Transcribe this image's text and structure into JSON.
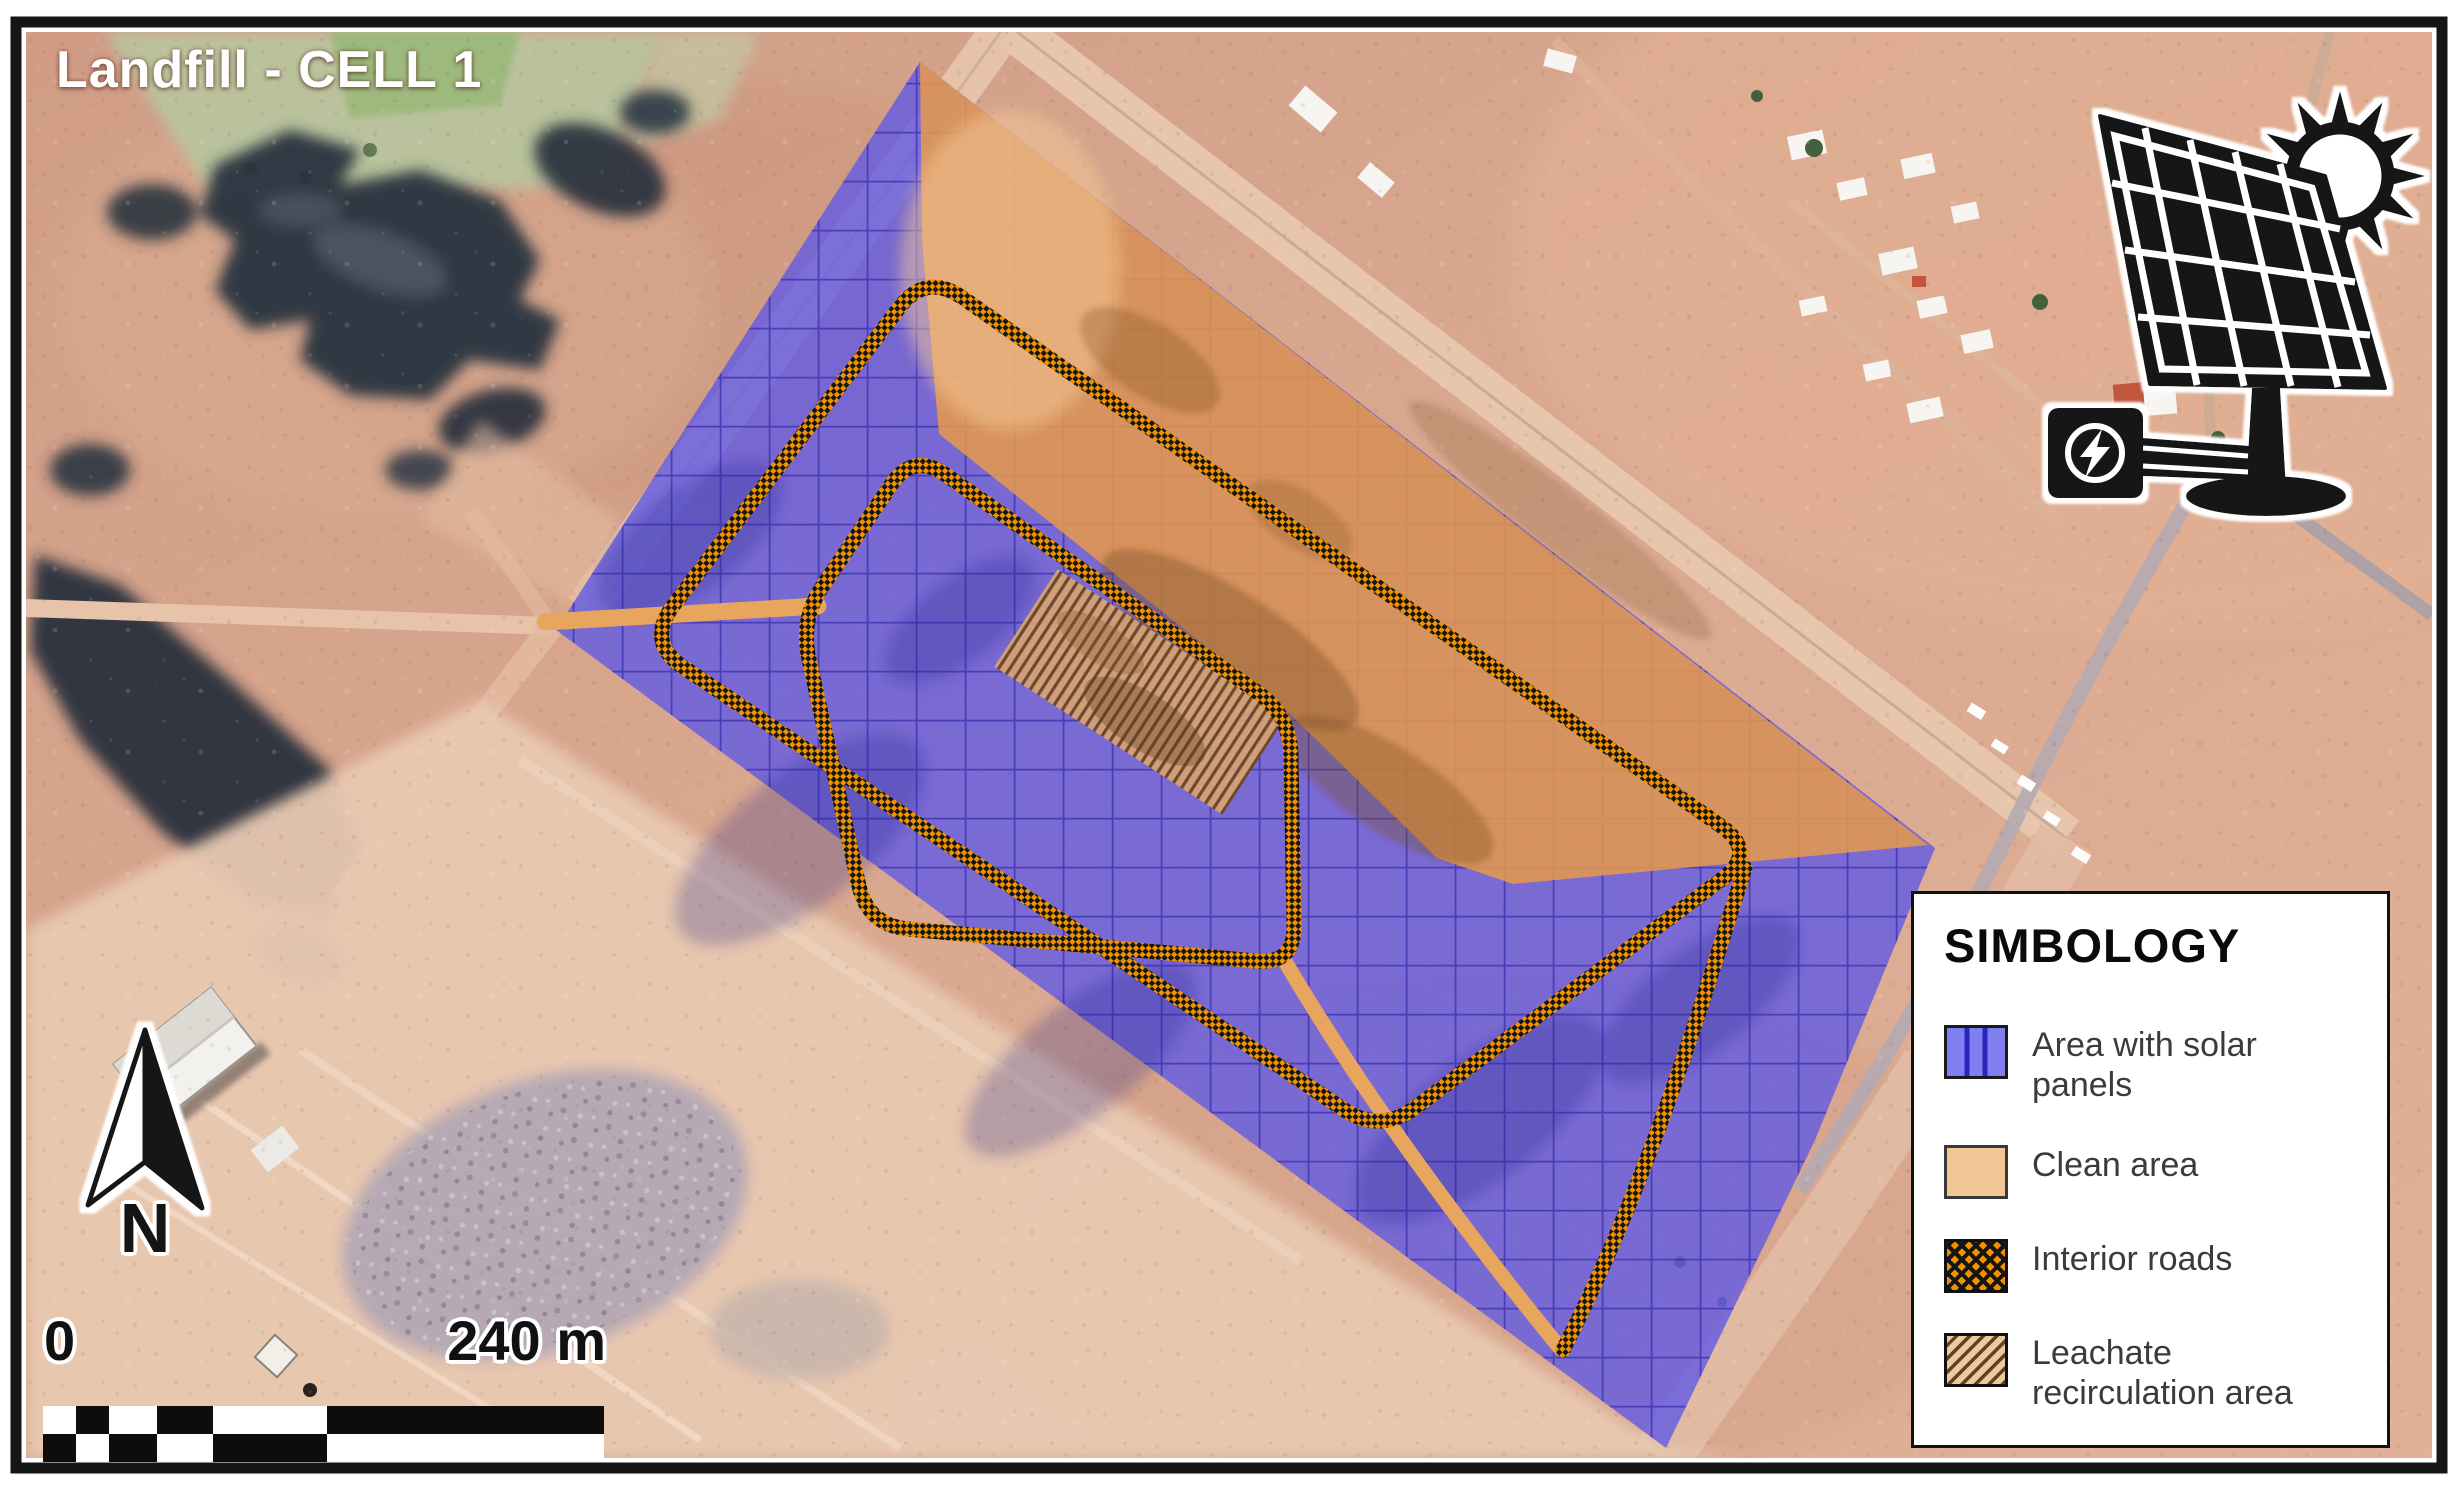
{
  "map": {
    "title": "Landfill - CELL 1",
    "north_label": "N",
    "scale": {
      "start": "0",
      "end": "240 m"
    },
    "colors": {
      "solar_area_blue": "#615ae4",
      "clean_area_orange": "#e89a4a",
      "interior_road_orange": "#f09200",
      "interior_road_black": "#161616",
      "leachate_tan": "#d2a273",
      "grid_blue": "#2b24a6"
    },
    "icons": [
      "solar-panel-sun-icon",
      "north-arrow-icon"
    ]
  },
  "legend": {
    "title": "SIMBOLOGY",
    "items": [
      {
        "id": "solar",
        "label": "Area with solar panels",
        "color": "#7f7ff0"
      },
      {
        "id": "clean",
        "label": "Clean area",
        "color": "#f2c795"
      },
      {
        "id": "roads",
        "label": "Interior roads",
        "color": "#f09200"
      },
      {
        "id": "leachate",
        "label": "Leachate recirculation area",
        "color": "#ecc9a0"
      }
    ]
  }
}
